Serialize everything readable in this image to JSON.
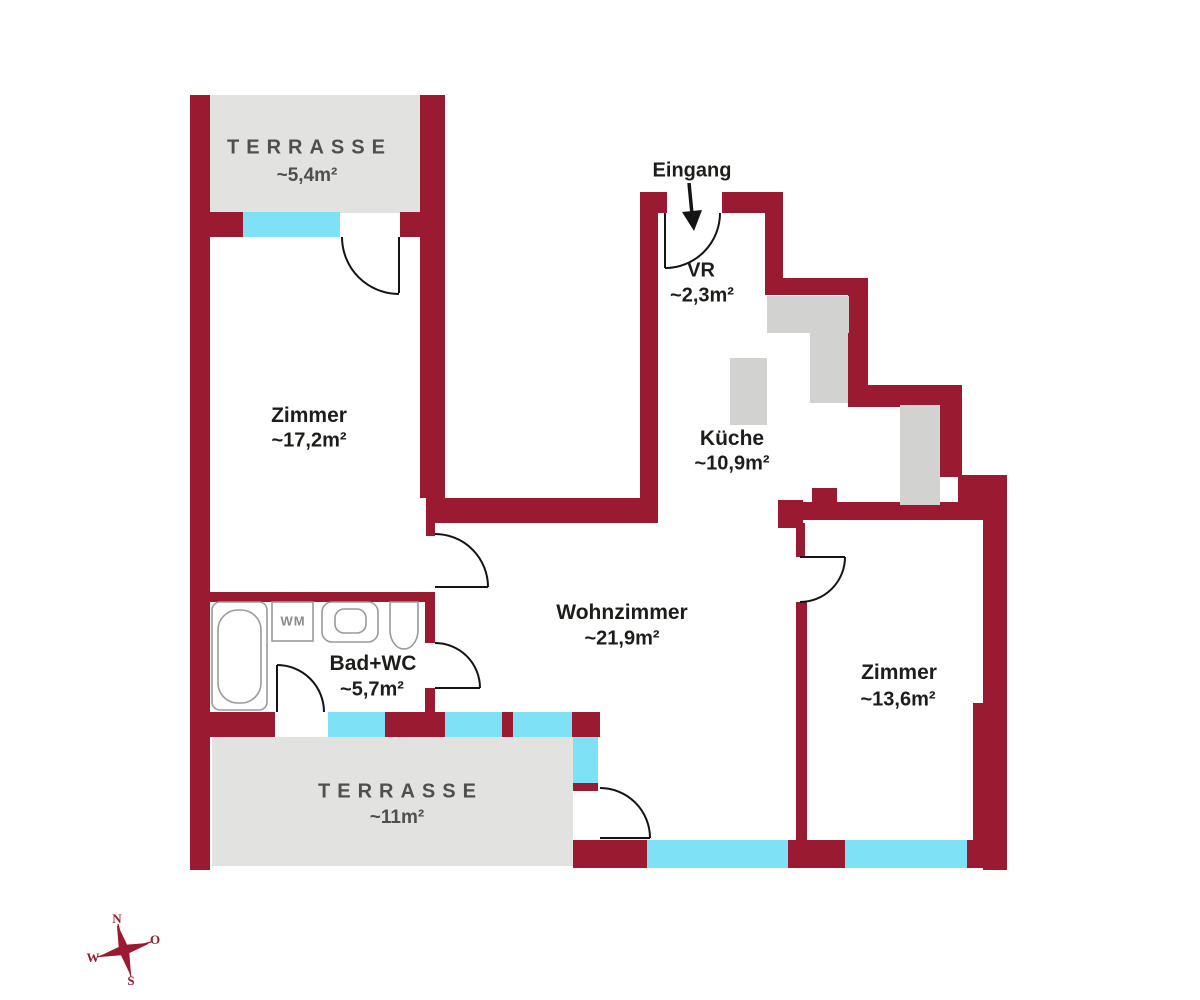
{
  "rooms": {
    "terrasse_top": {
      "name": "TERRASSE",
      "area": "~5,4m²"
    },
    "zimmer_left": {
      "name": "Zimmer",
      "area": "~17,2m²"
    },
    "vr": {
      "name": "VR",
      "area": "~2,3m²"
    },
    "kueche": {
      "name": "Küche",
      "area": "~10,9m²"
    },
    "wohnzimmer": {
      "name": "Wohnzimmer",
      "area": "~21,9m²"
    },
    "bad_wc": {
      "name": "Bad+WC",
      "area": "~5,7m²"
    },
    "zimmer_right": {
      "name": "Zimmer",
      "area": "~13,6m²"
    },
    "terrasse_bottom": {
      "name": "TERRASSE",
      "area": "~11m²"
    }
  },
  "entrance": {
    "label": "Eingang"
  },
  "fixtures": {
    "washing_machine": "WM"
  },
  "compass": {
    "north": "N",
    "east": "O",
    "south": "S",
    "west": "W"
  },
  "colors": {
    "wall": "#9a1b31",
    "window": "#7fe1f6",
    "terrace": "#e2e2e0",
    "kitchen_fixture": "#d2d2d0",
    "text": "#1d1d1b",
    "terrace_text": "#4f4f4f"
  }
}
